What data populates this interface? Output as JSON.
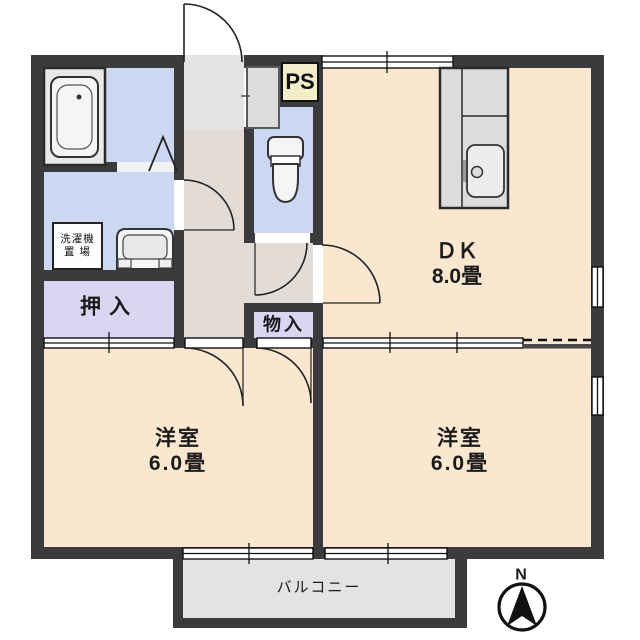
{
  "colors": {
    "wall": "#3b3b3d",
    "room": "#f9e8cf",
    "wet": "#ccd7f2",
    "closet": "#d9d5f2",
    "corridor": "#e3dbd6",
    "genkan": "#e4e3e2",
    "balcony": "#e3e3e3",
    "ps": "#f3eec9",
    "fixture": "#dcdcdf"
  },
  "rooms": {
    "dk": {
      "name": "ＤＫ",
      "size": "8.0畳"
    },
    "bedroom_left": {
      "name": "洋室",
      "size": "6.0畳"
    },
    "bedroom_right": {
      "name": "洋室",
      "size": "6.0畳"
    },
    "oshiire": {
      "name": "押入"
    },
    "monoire": {
      "name": "物入"
    },
    "ps": {
      "name": "PS"
    },
    "balcony": {
      "name": "バルコニー"
    },
    "laundry": {
      "line1": "洗濯機",
      "line2": "置 場"
    }
  },
  "compass": {
    "north": "N"
  }
}
